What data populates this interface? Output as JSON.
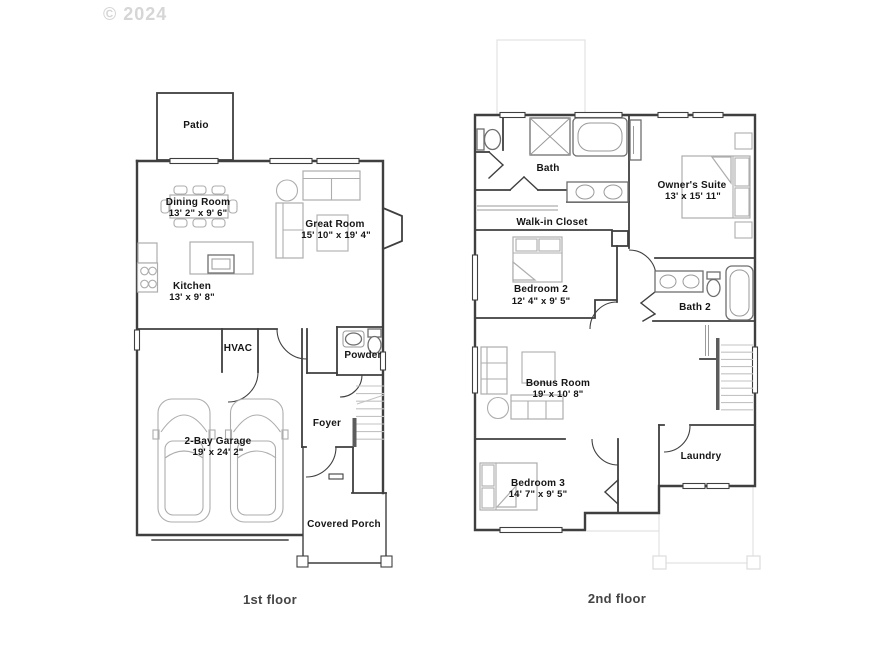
{
  "watermark": "© 2024",
  "colors": {
    "wall": "#3f3f3f",
    "furniture": "#adadad",
    "fixture": "#6e6e6e",
    "faint_roof": "#e2e2e2",
    "label": "#151515",
    "caption": "#454545",
    "watermark": "#d6d6d6"
  },
  "floor1": {
    "caption": "1st floor",
    "rooms": {
      "patio": {
        "label": "Patio"
      },
      "dining": {
        "label": "Dining Room",
        "dims": "13' 2\" x 9' 6\""
      },
      "great": {
        "label": "Great Room",
        "dims": "15' 10\" x 19' 4\""
      },
      "kitchen": {
        "label": "Kitchen",
        "dims": "13' x 9' 8\""
      },
      "hvac": {
        "label": "HVAC"
      },
      "powder": {
        "label": "Powder"
      },
      "garage": {
        "label": "2-Bay Garage",
        "dims": "19' x 24' 2\""
      },
      "foyer": {
        "label": "Foyer"
      },
      "porch": {
        "label": "Covered Porch"
      }
    }
  },
  "floor2": {
    "caption": "2nd floor",
    "rooms": {
      "bath": {
        "label": "Bath"
      },
      "closet": {
        "label": "Walk-in Closet"
      },
      "owners": {
        "label": "Owner's Suite",
        "dims": "13' x 15' 11\""
      },
      "bed2": {
        "label": "Bedroom 2",
        "dims": "12' 4\" x 9' 5\""
      },
      "bath2": {
        "label": "Bath 2"
      },
      "bonus": {
        "label": "Bonus Room",
        "dims": "19' x 10' 8\""
      },
      "laundry": {
        "label": "Laundry"
      },
      "bed3": {
        "label": "Bedroom 3",
        "dims": "14' 7\" x 9' 5\""
      }
    }
  }
}
